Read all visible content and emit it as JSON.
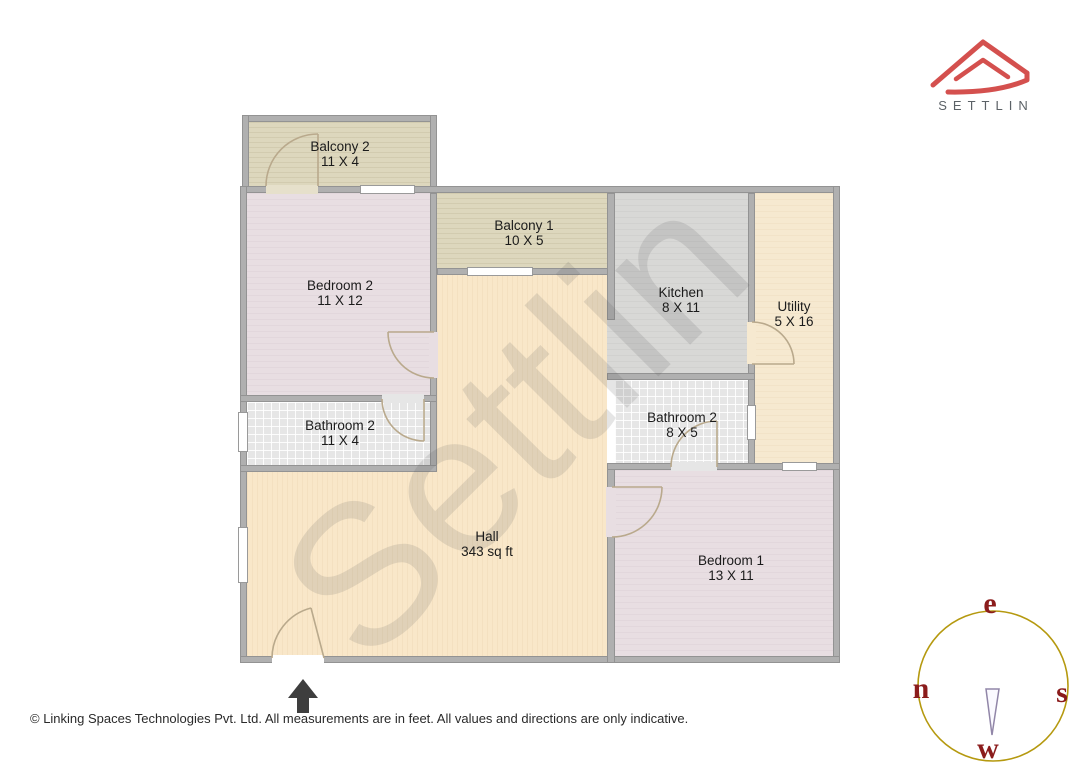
{
  "brand": {
    "logo_text": "SETTLIN",
    "logo_color": "#d4504e",
    "logo_text_color": "#5c6267"
  },
  "watermark": "Settlin",
  "rooms": [
    {
      "id": "balcony-2",
      "name": "Balcony 2",
      "dims": "11 X 4"
    },
    {
      "id": "bedroom-2",
      "name": "Bedroom 2",
      "dims": "11 X 12"
    },
    {
      "id": "balcony-1",
      "name": "Balcony 1",
      "dims": "10 X 5"
    },
    {
      "id": "kitchen",
      "name": "Kitchen",
      "dims": "8 X 11"
    },
    {
      "id": "utility",
      "name": "Utility",
      "dims": "5 X 16"
    },
    {
      "id": "bathroom-2-left",
      "name": "Bathroom 2",
      "dims": "11 X 4"
    },
    {
      "id": "bathroom-2-right",
      "name": "Bathroom 2",
      "dims": "8 X 5"
    },
    {
      "id": "hall",
      "name": "Hall",
      "dims": "343 sq ft"
    },
    {
      "id": "bedroom-1",
      "name": "Bedroom 1",
      "dims": "13 X 11"
    }
  ],
  "compass": {
    "top": "e",
    "left": "n",
    "right": "s",
    "bottom": "w",
    "ring_color": "#b5990f",
    "letter_color": "#8b1c1c",
    "needle_color": "#9186a8"
  },
  "footer": {
    "text": "© Linking Spaces Technologies Pvt. Ltd. All measurements are in feet. All values and directions are only indicative."
  },
  "palette": {
    "wall": "#b0b0b0",
    "balcony": "#ddd7bd",
    "bedroom": "#e8dee2",
    "kitchen": "#d8d8d6",
    "utility": "#f6e9d0",
    "hall": "#f9e7c9",
    "bathroom": "#e6e6e6",
    "door_arc": "#b9a98c",
    "watermark_gray": "#5a5a5a",
    "entrance_arrow": "#3e3e3e"
  }
}
